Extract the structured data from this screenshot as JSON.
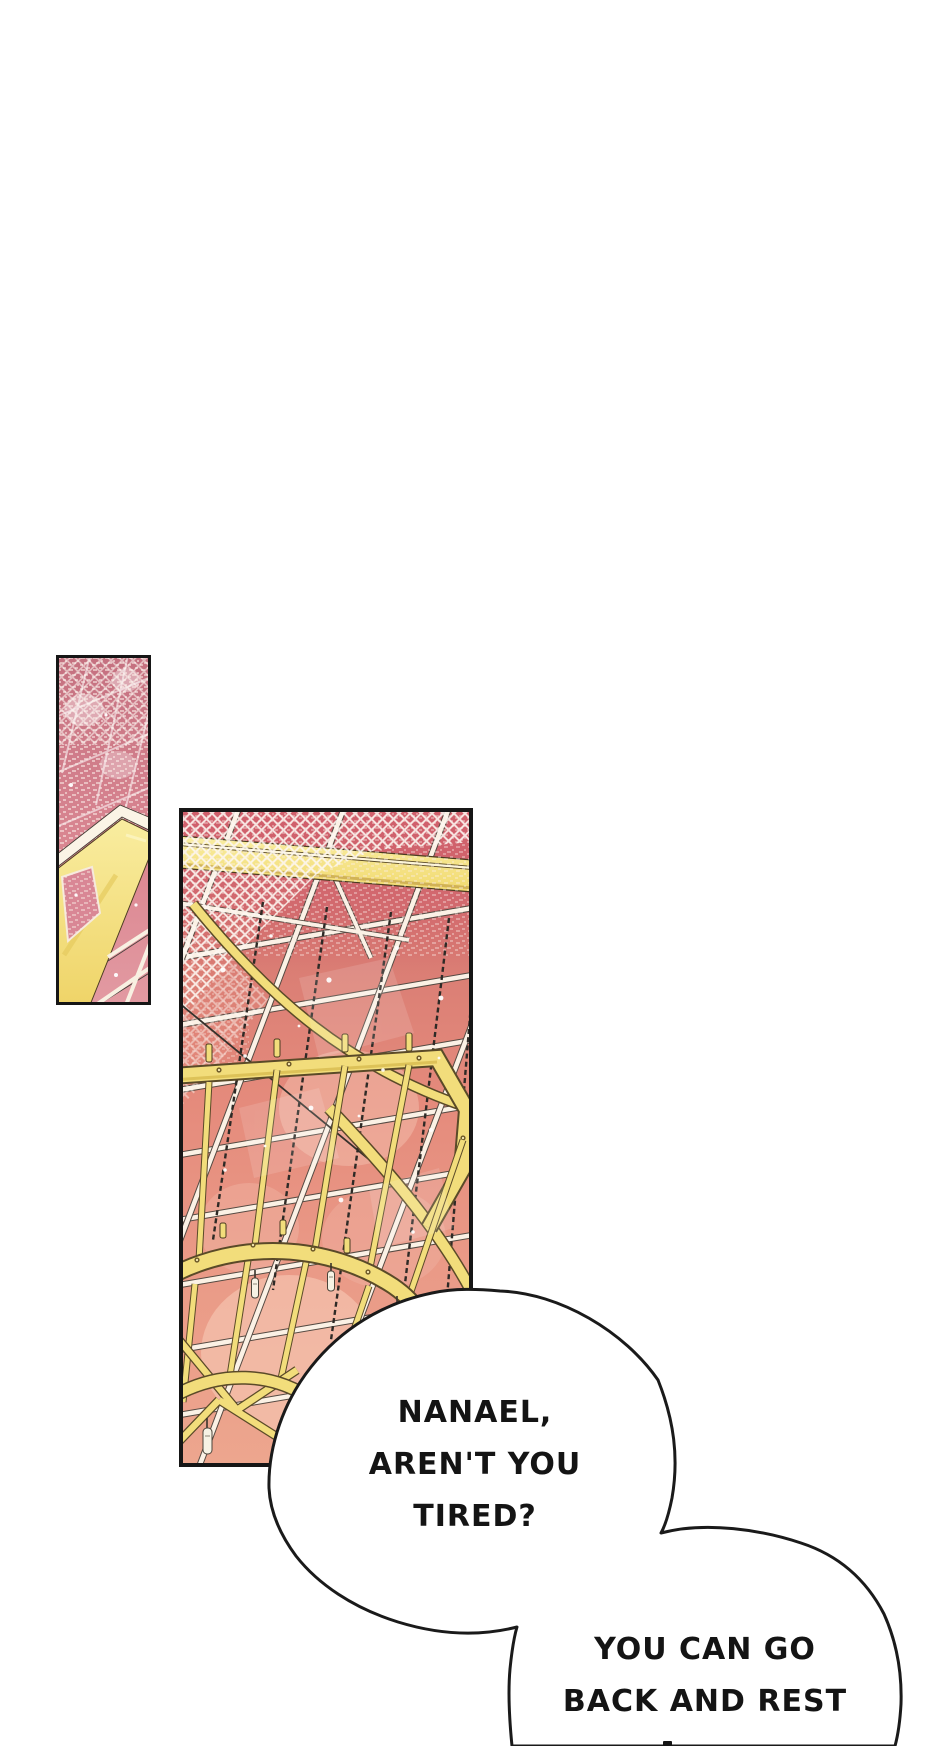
{
  "page": {
    "type": "webtoon-comic-page",
    "background": "#ffffff"
  },
  "artwork": {
    "panel_left": {
      "name": "stained-glass-ceiling-strip",
      "glass_pink": "#dd8a94",
      "mottled_rose": "#c4707f",
      "beam_yellow": "#f4e07c",
      "grid_cream": "#f8f0e2",
      "border": "#161616"
    },
    "panel_main": {
      "name": "glass-ceiling-with-golden-chandelier",
      "glass_rose": "#d05f6b",
      "glass_salmon": "#e89482",
      "chandelier_yellow": "#f2dd7b",
      "chain_dark": "#2e2a26",
      "grid_cream": "#fbf1e5",
      "border": "#161616"
    },
    "bubble_outline": "#1a1a1a",
    "bubble_fill": "#ffffff"
  },
  "dialogue": {
    "bubble1": {
      "lines": [
        "NANAEL,",
        "AREN'T YOU",
        "TIRED?"
      ]
    },
    "bubble2": {
      "lines": [
        "YOU CAN GO",
        "BACK AND REST"
      ]
    }
  }
}
